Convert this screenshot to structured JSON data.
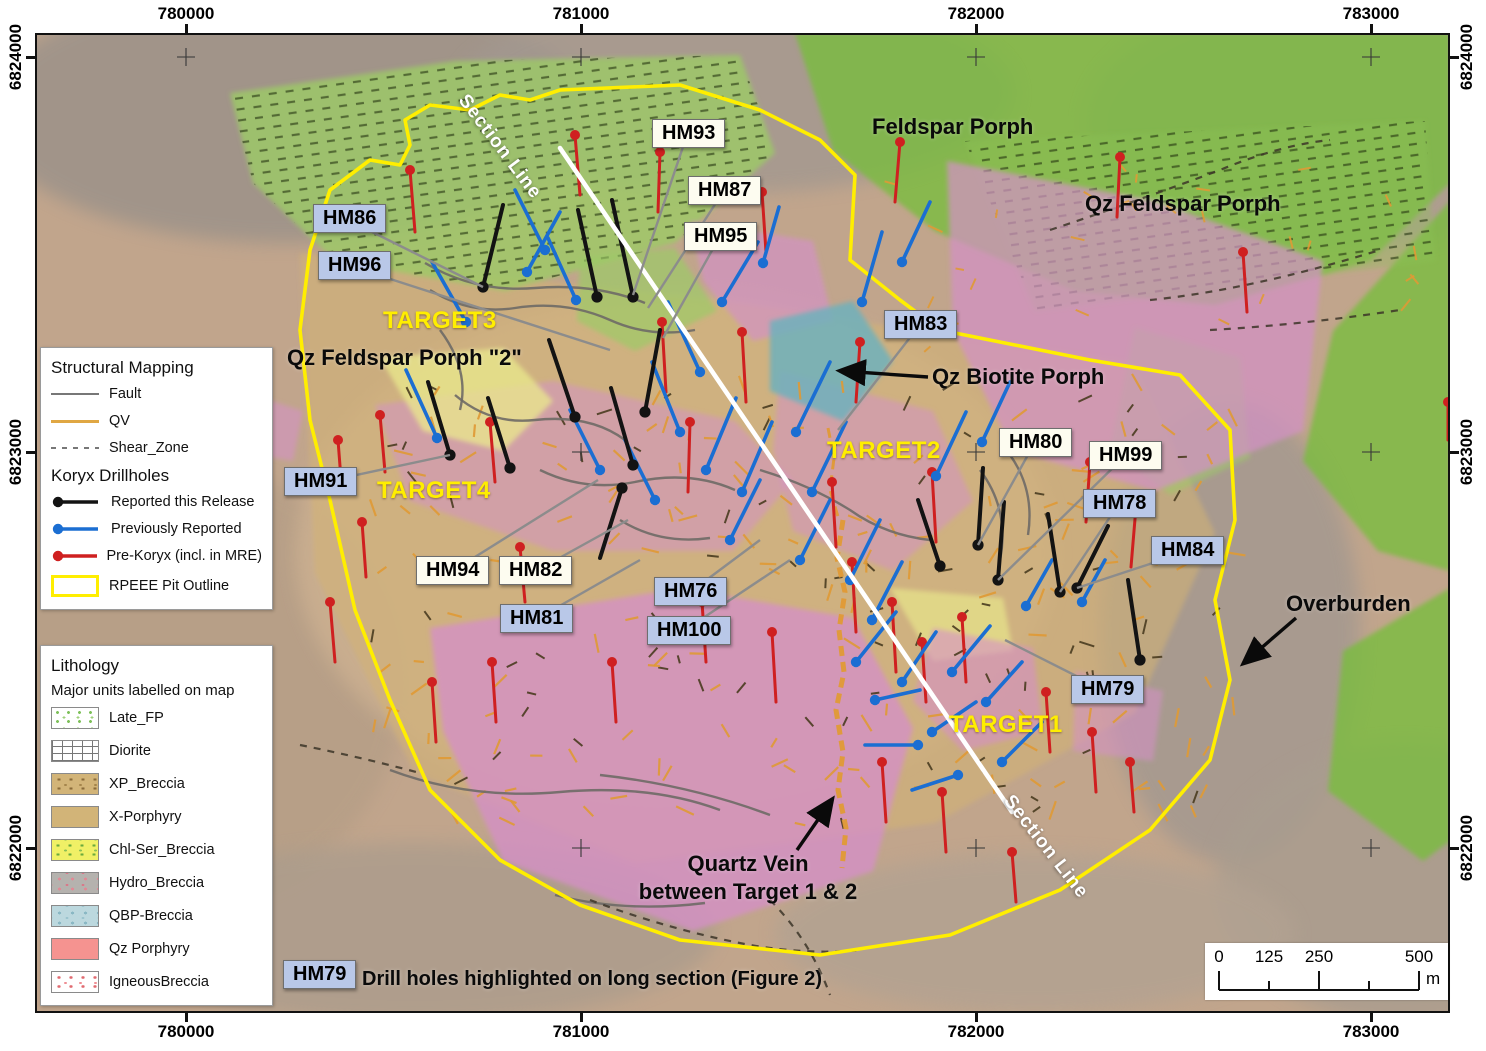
{
  "colors": {
    "blue_box": "#b9c8e8",
    "cream_box": "#fdfcf0",
    "pit": "#ffee00",
    "section": "#ffffff",
    "drill_black": "#131313",
    "drill_blue": "#1b6ed2",
    "drill_red": "#cf2020",
    "qv": "#e09a35",
    "fault": "#6e6a66",
    "leader": "#8c8c8c",
    "target": "#ffee00"
  },
  "axes": {
    "x_ticks": [
      {
        "label": "780000",
        "x": 186
      },
      {
        "label": "781000",
        "x": 581
      },
      {
        "label": "782000",
        "x": 976
      },
      {
        "label": "783000",
        "x": 1371
      }
    ],
    "y_ticks": [
      {
        "label": "6824000",
        "y": 57
      },
      {
        "label": "6823000",
        "y": 452
      },
      {
        "label": "6822000",
        "y": 848
      }
    ]
  },
  "legend_structural": {
    "title": "Structural Mapping",
    "items": [
      {
        "label": "Fault",
        "key": "fault"
      },
      {
        "label": "QV",
        "key": "qv"
      },
      {
        "label": "Shear_Zone",
        "key": "shear"
      }
    ]
  },
  "legend_drillholes": {
    "title": "Koryx Drillholes",
    "items": [
      {
        "label": "Reported this Release",
        "key": "black"
      },
      {
        "label": "Previously Reported",
        "key": "blue"
      },
      {
        "label": "Pre-Koryx (incl. in MRE)",
        "key": "red"
      },
      {
        "label": "RPEEE Pit Outline",
        "key": "pit"
      }
    ]
  },
  "legend_lithology": {
    "title": "Lithology",
    "subtitle": "Major units labelled on map",
    "items": [
      {
        "label": "Late_FP",
        "key": "late_fp"
      },
      {
        "label": "Diorite",
        "key": "diorite"
      },
      {
        "label": "XP_Breccia",
        "key": "xp_breccia"
      },
      {
        "label": "X-Porphyry",
        "key": "x_porphyry"
      },
      {
        "label": "Chl-Ser_Breccia",
        "key": "chl_ser"
      },
      {
        "label": "Hydro_Breccia",
        "key": "hydro"
      },
      {
        "label": "QBP-Breccia",
        "key": "qbp"
      },
      {
        "label": "Qz Porphyry",
        "key": "qz_porphyry"
      },
      {
        "label": "IgneousBreccia",
        "key": "igneous"
      }
    ]
  },
  "callouts": [
    {
      "label": "HM93",
      "style": "cream",
      "x": 652,
      "y": 119,
      "tx": 633,
      "ty": 295
    },
    {
      "label": "HM87",
      "style": "cream",
      "x": 688,
      "y": 176,
      "tx": 648,
      "ty": 308
    },
    {
      "label": "HM95",
      "style": "cream",
      "x": 684,
      "y": 222,
      "tx": 663,
      "ty": 338
    },
    {
      "label": "HM86",
      "style": "blue",
      "x": 313,
      "y": 204,
      "tx": 483,
      "ty": 287
    },
    {
      "label": "HM96",
      "style": "blue",
      "x": 318,
      "y": 251,
      "tx": 610,
      "ty": 350
    },
    {
      "label": "HM83",
      "style": "blue",
      "x": 884,
      "y": 310,
      "tx": 838,
      "ty": 430
    },
    {
      "label": "HM80",
      "style": "cream",
      "x": 999,
      "y": 428,
      "tx": 978,
      "ty": 545
    },
    {
      "label": "HM99",
      "style": "cream",
      "x": 1089,
      "y": 441,
      "tx": 998,
      "ty": 580
    },
    {
      "label": "HM78",
      "style": "blue",
      "x": 1083,
      "y": 489,
      "tx": 1060,
      "ty": 592
    },
    {
      "label": "HM84",
      "style": "blue",
      "x": 1151,
      "y": 536,
      "tx": 1077,
      "ty": 588
    },
    {
      "label": "HM91",
      "style": "blue",
      "x": 284,
      "y": 467,
      "tx": 450,
      "ty": 455
    },
    {
      "label": "HM94",
      "style": "cream",
      "x": 416,
      "y": 556,
      "tx": 598,
      "ty": 480
    },
    {
      "label": "HM82",
      "style": "cream",
      "x": 499,
      "y": 556,
      "tx": 628,
      "ty": 520
    },
    {
      "label": "HM81",
      "style": "blue",
      "x": 500,
      "y": 604,
      "tx": 640,
      "ty": 560
    },
    {
      "label": "HM76",
      "style": "blue",
      "x": 654,
      "y": 577,
      "tx": 760,
      "ty": 540
    },
    {
      "label": "HM100",
      "style": "blue",
      "x": 647,
      "y": 616,
      "tx": 790,
      "ty": 560
    },
    {
      "label": "HM79",
      "style": "blue",
      "x": 1071,
      "y": 675,
      "tx": 1005,
      "ty": 640
    }
  ],
  "targets": [
    {
      "label": "TARGET3",
      "x": 383,
      "y": 307
    },
    {
      "label": "TARGET4",
      "x": 377,
      "y": 477
    },
    {
      "label": "TARGET2",
      "x": 827,
      "y": 437
    },
    {
      "label": "TARGET1",
      "x": 949,
      "y": 711
    }
  ],
  "map_labels": [
    {
      "text": "Feldspar Porph",
      "x": 872,
      "y": 114
    },
    {
      "text": "Qz Feldspar Porph",
      "x": 1085,
      "y": 191
    },
    {
      "text": "Qz Feldspar Porph \"2\"",
      "x": 287,
      "y": 345
    },
    {
      "text": "Qz Biotite Porph",
      "x": 932,
      "y": 364
    },
    {
      "text": "Overburden",
      "x": 1286,
      "y": 591
    }
  ],
  "quartz_vein_label": {
    "line1": "Quartz Vein",
    "line2": "between Target 1 & 2"
  },
  "arrows": [
    [
      928,
      377,
      842,
      371
    ],
    [
      1296,
      618,
      1245,
      662
    ],
    [
      797,
      850,
      831,
      801
    ]
  ],
  "section_line": {
    "x1": 560,
    "y1": 148,
    "x2": 1012,
    "y2": 812,
    "labels": [
      {
        "text": "Section Line",
        "x": 497,
        "y": 146,
        "rot": 53
      },
      {
        "text": "Section Line",
        "x": 1043,
        "y": 846,
        "rot": 52
      }
    ]
  },
  "note": {
    "box_label": "HM79",
    "text": "Drill holes highlighted on long section (Figure 2)"
  },
  "scalebar": {
    "labels": [
      {
        "text": "0",
        "px": 14
      },
      {
        "text": "125",
        "px": 64
      },
      {
        "text": "250",
        "px": 114
      },
      {
        "text": "500",
        "px": 214
      }
    ],
    "unit": "m",
    "tick_px": [
      14,
      64,
      114,
      164,
      214
    ]
  },
  "geometry": {
    "terrain": [
      [
        250,
        80,
        300,
        130,
        "#9a9189"
      ],
      [
        700,
        60,
        280,
        100,
        "#a29890"
      ],
      [
        1290,
        90,
        240,
        130,
        "#aa9d90"
      ],
      [
        1195,
        600,
        130,
        230,
        "#a29890"
      ],
      [
        1370,
        850,
        190,
        140,
        "#a89c8f"
      ],
      [
        150,
        650,
        220,
        220,
        "#b59e86"
      ],
      [
        640,
        520,
        380,
        260,
        "#cdb191"
      ],
      [
        380,
        900,
        300,
        90,
        "#ab9c8c"
      ],
      [
        1000,
        900,
        260,
        80,
        "#b2a292"
      ]
    ],
    "geology": [
      {
        "d": "M265,220 L700,270 L1100,330 L1180,500 L1100,680 L900,790 L600,830 L380,740 L280,540 Z",
        "c": "#d3b272",
        "o": 0.55
      },
      {
        "d": "M195,60 L420,28 L705,22 L740,120 L640,210 L470,258 L300,228 L218,150 Z",
        "c": "#9ccb66",
        "o": 0.8,
        "dash": true
      },
      {
        "d": "M760,0 L1415,0 L1415,150 L1335,228 L1180,272 L1040,258 L900,198 L798,118 Z",
        "c": "#77bd3e",
        "o": 0.78
      },
      {
        "d": "M1415,168 L1298,298 L1268,428 L1343,518 L1415,538 Z",
        "c": "#77bd3e",
        "o": 0.78
      },
      {
        "d": "M1415,555 L1308,618 L1293,758 L1388,828 L1415,808 Z",
        "c": "#77bd3e",
        "o": 0.78
      },
      {
        "d": "M930,108 L1390,88 L1400,228 L1000,278 Z",
        "c": "#8cc455",
        "o": 0.35,
        "dash": true
      },
      {
        "d": "M545,225 L640,215 L682,278 L600,318 L542,288 Z",
        "c": "#9ccb66",
        "o": 0.7
      },
      {
        "d": "M1100,295 L1205,325 L1215,425 L1135,462 L1075,415 Z",
        "c": "#9ccb66",
        "o": 0.55
      },
      {
        "d": "M912,128 L1120,168 L1288,228 L1268,398 L1120,458 L978,418 L918,298 Z",
        "c": "#d392c5",
        "o": 0.72
      },
      {
        "d": "M655,188 L778,208 L798,288 L718,308 L668,248 Z",
        "c": "#d392c5",
        "o": 0.7
      },
      {
        "d": "M340,372 L518,348 L700,388 L758,448 L698,518 L518,518 L375,468 Z",
        "c": "#d392c5",
        "o": 0.55
      },
      {
        "d": "M745,338 L898,378 L938,468 L858,538 L758,498 L738,418 Z",
        "c": "#d392c5",
        "o": 0.55
      },
      {
        "d": "M735,288 L818,268 L858,328 L808,388 L735,358 Z",
        "c": "#6fb0bc",
        "o": 0.85
      },
      {
        "d": "M345,325 L468,315 L518,368 L468,418 L388,398 Z",
        "c": "#e9e98c",
        "o": 0.75
      },
      {
        "d": "M855,555 L968,565 L978,618 L898,628 Z",
        "c": "#e9e98c",
        "o": 0.65
      },
      {
        "d": "M395,595 L648,555 L818,585 L878,695 L838,838 L658,898 L468,828 L408,698 Z",
        "c": "#d58fc7",
        "o": 0.78
      },
      {
        "d": "M898,595 L998,615 L1008,698 L928,718 L878,668 Z",
        "c": "#d58fc7",
        "o": 0.6
      },
      {
        "d": "M1040,638 L1128,658 L1118,728 L1038,718 Z",
        "c": "#d58fc7",
        "o": 0.55
      },
      {
        "d": "M205,358 L268,378 L258,428 L198,418 Z",
        "c": "#d392c5",
        "o": 0.6
      }
    ],
    "pit": "M525,57 L645,52 L725,77 L785,107 L820,142 L815,227 L865,267 L905,297 L1055,327 L1145,342 L1195,397 L1200,487 L1180,567 L1195,647 L1175,727 L1115,797 L1025,857 L915,902 L785,922 L645,907 L545,872 L465,827 L395,757 L355,667 L320,577 L295,467 L275,387 L265,297 L275,217 L295,157 L335,127 L365,132 L375,112 L370,87 L395,72 L435,77 L465,62 L495,67 Z",
    "faults": [
      "M395,257 q40,25 85,18 q50,-8 95,12 q40,18 85,10",
      "M420,362 q35,30 80,25 q55,-6 90,20",
      "M505,437 q45,22 95,12 q55,-12 100,8",
      "M585,487 q40,25 90,18",
      "M725,437 q50,15 90,40 q35,25 80,30",
      "M945,437 q30,40 20,90",
      "M975,422 q25,35 18,80",
      "M405,297 q30,40 20,80",
      "M355,737 q80,30 170,22 q90,-8 160,18",
      "M520,862 q70,18 150,8",
      "M565,742 q90,10 170,40",
      "M390,230 q50,30 110,25 q60,-5 110,15"
    ],
    "shear_lines": [
      "M1015,197 q90,-30 170,-60 q60,-25 110,-30",
      "M1115,267 q100,-10 230,-50",
      "M1175,297 q90,-5 190,-20",
      "M555,867 q80,30 160,45 q60,10 110,5",
      "M265,712 q60,12 120,28",
      "M735,867 q40,40 60,95"
    ],
    "quartz_vein": [
      "M808,487 l-6,38 l8,34 l-6,38 l5,42 l-8,38 l7,42 l-5,38 l8,38 l-4,40",
      "M793,395 l6,30 l-4,32 l9,30"
    ],
    "drill_black": [
      [
        483,
        287,
        503,
        205
      ],
      [
        633,
        297,
        612,
        200
      ],
      [
        597,
        297,
        578,
        210
      ],
      [
        575,
        417,
        549,
        340
      ],
      [
        645,
        412,
        660,
        330
      ],
      [
        450,
        455,
        428,
        382
      ],
      [
        510,
        468,
        488,
        398
      ],
      [
        633,
        465,
        611,
        388
      ],
      [
        622,
        488,
        600,
        558
      ],
      [
        978,
        545,
        983,
        468
      ],
      [
        998,
        580,
        1004,
        502
      ],
      [
        1060,
        592,
        1048,
        514
      ],
      [
        1077,
        588,
        1108,
        526
      ],
      [
        940,
        566,
        918,
        500
      ],
      [
        1140,
        660,
        1128,
        580
      ]
    ],
    "drill_blue": [
      [
        437,
        438,
        406,
        370
      ],
      [
        466,
        322,
        432,
        262
      ],
      [
        527,
        272,
        560,
        212
      ],
      [
        576,
        300,
        548,
        238
      ],
      [
        700,
        372,
        668,
        302
      ],
      [
        722,
        302,
        758,
        242
      ],
      [
        763,
        263,
        779,
        207
      ],
      [
        680,
        432,
        652,
        362
      ],
      [
        706,
        470,
        736,
        398
      ],
      [
        742,
        492,
        772,
        422
      ],
      [
        796,
        432,
        830,
        362
      ],
      [
        812,
        492,
        846,
        422
      ],
      [
        862,
        302,
        882,
        232
      ],
      [
        902,
        262,
        930,
        202
      ],
      [
        936,
        476,
        966,
        412
      ],
      [
        982,
        442,
        1010,
        382
      ],
      [
        872,
        620,
        902,
        562
      ],
      [
        856,
        662,
        896,
        612
      ],
      [
        902,
        682,
        936,
        632
      ],
      [
        952,
        672,
        990,
        626
      ],
      [
        1026,
        606,
        1052,
        560
      ],
      [
        986,
        702,
        1022,
        662
      ],
      [
        932,
        732,
        976,
        702
      ],
      [
        1002,
        762,
        1042,
        722
      ],
      [
        545,
        250,
        515,
        190
      ],
      [
        600,
        470,
        570,
        410
      ],
      [
        655,
        500,
        625,
        440
      ],
      [
        730,
        540,
        760,
        480
      ],
      [
        800,
        560,
        830,
        500
      ],
      [
        850,
        580,
        880,
        520
      ],
      [
        1082,
        602,
        1105,
        560
      ],
      [
        918,
        745,
        865,
        745
      ],
      [
        958,
        775,
        912,
        790
      ],
      [
        875,
        700,
        920,
        690
      ]
    ],
    "drill_red": [
      [
        410,
        170,
        415,
        232
      ],
      [
        575,
        135,
        580,
        195
      ],
      [
        900,
        142,
        895,
        202
      ],
      [
        1120,
        157,
        1117,
        217
      ],
      [
        1243,
        252,
        1247,
        312
      ],
      [
        660,
        152,
        658,
        212
      ],
      [
        762,
        192,
        766,
        252
      ],
      [
        380,
        415,
        385,
        472
      ],
      [
        490,
        422,
        495,
        482
      ],
      [
        662,
        322,
        666,
        392
      ],
      [
        690,
        422,
        688,
        492
      ],
      [
        742,
        332,
        746,
        402
      ],
      [
        860,
        342,
        856,
        402
      ],
      [
        932,
        472,
        936,
        542
      ],
      [
        1090,
        462,
        1086,
        522
      ],
      [
        1136,
        507,
        1131,
        567
      ],
      [
        330,
        602,
        335,
        662
      ],
      [
        432,
        682,
        436,
        742
      ],
      [
        520,
        547,
        525,
        602
      ],
      [
        612,
        662,
        616,
        722
      ],
      [
        702,
        602,
        706,
        662
      ],
      [
        772,
        632,
        776,
        702
      ],
      [
        852,
        562,
        856,
        632
      ],
      [
        892,
        602,
        896,
        672
      ],
      [
        922,
        642,
        926,
        702
      ],
      [
        962,
        617,
        966,
        682
      ],
      [
        1046,
        692,
        1050,
        752
      ],
      [
        1092,
        732,
        1096,
        792
      ],
      [
        1130,
        762,
        1134,
        812
      ],
      [
        882,
        762,
        886,
        822
      ],
      [
        942,
        792,
        946,
        852
      ],
      [
        1012,
        852,
        1016,
        902
      ],
      [
        832,
        482,
        836,
        547
      ],
      [
        492,
        662,
        496,
        722
      ],
      [
        362,
        522,
        366,
        577
      ],
      [
        1448,
        402,
        1448,
        440
      ],
      [
        255,
        352,
        258,
        400
      ],
      [
        338,
        440,
        342,
        492
      ]
    ],
    "crosses": {
      "xs": [
        186,
        581,
        976,
        1371
      ],
      "ys": [
        57,
        452,
        848
      ]
    },
    "qv_ticks": {
      "count": 160,
      "box": [
        335,
        343,
        1205,
        793
      ],
      "count2": 28,
      "box2": [
        855,
        123,
        1385,
        323
      ]
    },
    "struct_ticks": {
      "count": 80,
      "box": [
        335,
        343,
        1205,
        793
      ]
    }
  }
}
